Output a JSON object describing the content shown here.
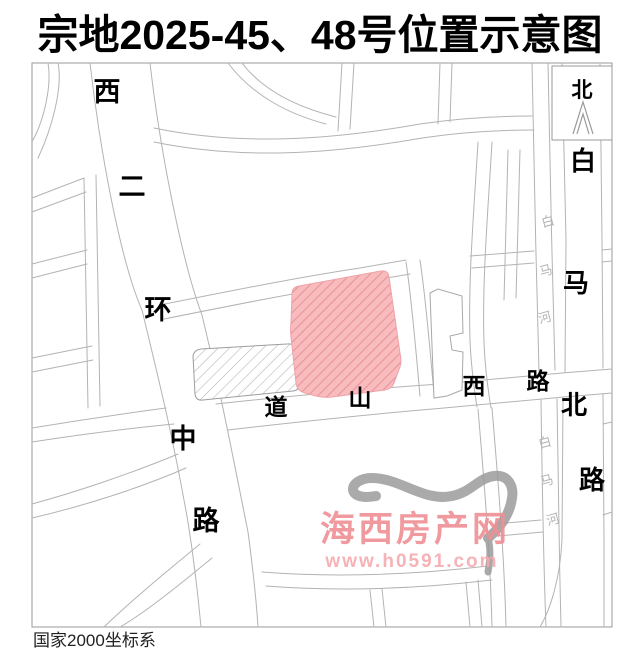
{
  "title": "宗地2025-45、48号位置示意图",
  "footer": {
    "coordinate_system": "国家2000坐标系"
  },
  "compass": {
    "north_label": "北"
  },
  "roads": {
    "xierhuanzhong": {
      "full_name": "西二环中路",
      "chars": [
        "西",
        "二",
        "环",
        "中",
        "路"
      ]
    },
    "daoshanxi": {
      "full_name": "道山西路",
      "chars": [
        "道",
        "山",
        "西",
        "路"
      ]
    },
    "baimabei": {
      "full_name": "白马北路",
      "chars": [
        "白",
        "马",
        "北",
        "路"
      ]
    },
    "river_upper": {
      "full_name": "白马河",
      "chars": [
        "白",
        "马",
        "河"
      ]
    },
    "river_lower": {
      "full_name": "白马河",
      "chars": [
        "白",
        "马",
        "河"
      ]
    }
  },
  "parcels": {
    "red_parcel": {
      "fill": "#f9bcbe",
      "hatch": "#e8969c"
    },
    "gray_parcel": {
      "fill": "#ffffff",
      "hatch": "#b8b8b8"
    }
  },
  "watermark": {
    "site_name": "海西房产网",
    "site_url": "www.h0591.com",
    "color": "#ef8f94"
  },
  "map": {
    "line_color": "#b3b3b3",
    "border_color": "#9a9a9a"
  }
}
